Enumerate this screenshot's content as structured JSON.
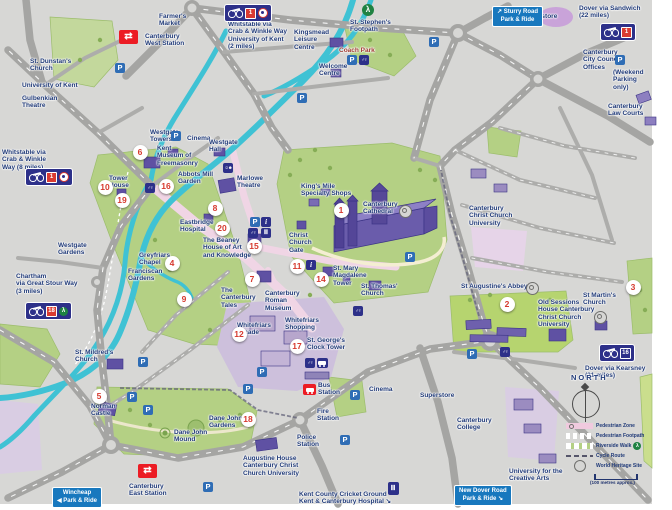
{
  "map_title": "Canterbury city centre visitor map",
  "colors": {
    "background": "#d7d7d5",
    "road": "#a5a5a3",
    "river": "#3fc2d4",
    "park": "#b4d084",
    "pedestrian_zone": "#f0cade",
    "shopping_zone": "#cdc0dc",
    "building": "#5f51a3",
    "label_text": "#203a78",
    "marker_number": "#d6392e",
    "parking_blue": "#2f6db5",
    "sign_navy": "#2d3089",
    "park_ride_blue": "#1878be",
    "rail_red": "#ec1c24",
    "riverside_green": "#1f8242"
  },
  "labels": [
    {
      "t": "University of Kent",
      "x": 22,
      "y": 82
    },
    {
      "t": "Gulbenkian\nTheatre",
      "x": 22,
      "y": 95
    },
    {
      "t": "St. Dunstan's\nChurch",
      "x": 30,
      "y": 58
    },
    {
      "t": "Farmer's\nMarket",
      "x": 159,
      "y": 13
    },
    {
      "t": "Canterbury\nWest Station",
      "x": 145,
      "y": 33
    },
    {
      "t": "Whitstable via\nCrab & Winkle Way\nUniversity of Kent\n(2 miles)",
      "x": 228,
      "y": 21
    },
    {
      "t": "Kingsmead\nLeisure\nCentre",
      "x": 294,
      "y": 29
    },
    {
      "t": "St. Stephen's\nFootpath",
      "x": 350,
      "y": 19
    },
    {
      "t": "Superstore",
      "x": 523,
      "y": 13
    },
    {
      "t": "Coach Park",
      "x": 339,
      "y": 47,
      "c": "#a03a30"
    },
    {
      "t": "Welcome\nCentre",
      "x": 319,
      "y": 63
    },
    {
      "t": "Dover via Sandwich\n(22 miles)",
      "x": 579,
      "y": 5
    },
    {
      "t": "Canterbury\nCity Council\nOffices",
      "x": 583,
      "y": 49
    },
    {
      "t": "(Weekend\nParking\nonly)",
      "x": 613,
      "y": 69
    },
    {
      "t": "Canterbury\nLaw Courts",
      "x": 608,
      "y": 103
    },
    {
      "t": "Whitstable via\nCrab & Winkle\nWay (8 miles)",
      "x": 2,
      "y": 149
    },
    {
      "t": "Westgate\nTowers",
      "x": 150,
      "y": 129
    },
    {
      "t": "Kent\nMuseum of\nFreemasonry",
      "x": 157,
      "y": 145
    },
    {
      "t": "Cinema",
      "x": 187,
      "y": 135
    },
    {
      "t": "Westgate\nHall",
      "x": 209,
      "y": 139
    },
    {
      "t": "Abbots Mill\nGarden",
      "x": 178,
      "y": 171
    },
    {
      "t": "Marlowe\nTheatre",
      "x": 237,
      "y": 175
    },
    {
      "t": "Tower\nHouse",
      "x": 109,
      "y": 175
    },
    {
      "t": "Westgate\nGardens",
      "x": 58,
      "y": 242
    },
    {
      "t": "Eastbridge\nHospital",
      "x": 180,
      "y": 219
    },
    {
      "t": "King's Mile\nSpecialty Shops",
      "x": 301,
      "y": 183
    },
    {
      "t": "Canterbury\nCathedral",
      "x": 363,
      "y": 201
    },
    {
      "t": "Christ\nChurch\nGate",
      "x": 289,
      "y": 232
    },
    {
      "t": "The Beaney\nHouse of Art\nand Knowledge",
      "x": 203,
      "y": 237
    },
    {
      "t": "The\nCanterbury\nTales",
      "x": 221,
      "y": 287
    },
    {
      "t": "Canterbury\nRoman\nMuseum",
      "x": 265,
      "y": 290
    },
    {
      "t": "St. Mary\nMagdalene\nTower",
      "x": 333,
      "y": 265
    },
    {
      "t": "St. Thomas'\nChurch",
      "x": 361,
      "y": 283
    },
    {
      "t": "Greyfriars\nChapel",
      "x": 139,
      "y": 252
    },
    {
      "t": "Franciscan\nGardens",
      "x": 128,
      "y": 268
    },
    {
      "t": "Chartham\nvia Great Stour Way\n(3 miles)",
      "x": 16,
      "y": 273
    },
    {
      "t": "St. Mildred's\nChurch",
      "x": 75,
      "y": 349
    },
    {
      "t": "Norman\nCastle",
      "x": 91,
      "y": 403
    },
    {
      "t": "Whitefriars\nArcade",
      "x": 237,
      "y": 322
    },
    {
      "t": "Whitefriars\nShopping",
      "x": 285,
      "y": 317
    },
    {
      "t": "St. George's\nClock Tower",
      "x": 307,
      "y": 337
    },
    {
      "t": "Bus\nStation",
      "x": 318,
      "y": 382
    },
    {
      "t": "Fire\nStation",
      "x": 317,
      "y": 408
    },
    {
      "t": "Police\nStation",
      "x": 297,
      "y": 434
    },
    {
      "t": "Cinema",
      "x": 369,
      "y": 386
    },
    {
      "t": "Superstore",
      "x": 420,
      "y": 392
    },
    {
      "t": "Dane John\nMound",
      "x": 174,
      "y": 429
    },
    {
      "t": "Dane John\nGardens",
      "x": 209,
      "y": 415
    },
    {
      "t": "Canterbury\nEast Station",
      "x": 129,
      "y": 483
    },
    {
      "t": "Augustine House\nCanterbury Christ\nChurch University",
      "x": 243,
      "y": 455
    },
    {
      "t": "Kent County Cricket Ground\nKent & Canterbury Hospital ↘",
      "x": 299,
      "y": 491
    },
    {
      "t": "Canterbury\nChrist Church\nUniversity",
      "x": 469,
      "y": 205
    },
    {
      "t": "St Augustine's Abbey",
      "x": 461,
      "y": 283
    },
    {
      "t": "Old Sessions\nHouse Canterbury\nChrist Church\nUniversity",
      "x": 538,
      "y": 299
    },
    {
      "t": "St Martin's\nChurch",
      "x": 583,
      "y": 292
    },
    {
      "t": "Canterbury\nCollege",
      "x": 457,
      "y": 417
    },
    {
      "t": "University for the\nCreative Arts",
      "x": 509,
      "y": 468
    },
    {
      "t": "Dover via Kearsney\n(21 miles)",
      "x": 585,
      "y": 365
    },
    {
      "t": "NORTH",
      "x": 571,
      "y": 374,
      "s": 7.5,
      "ls": 2
    }
  ],
  "markers": [
    {
      "n": 1,
      "x": 341,
      "y": 210
    },
    {
      "n": 2,
      "x": 507,
      "y": 304
    },
    {
      "n": 3,
      "x": 633,
      "y": 287
    },
    {
      "n": 4,
      "x": 172,
      "y": 263
    },
    {
      "n": 5,
      "x": 99,
      "y": 396
    },
    {
      "n": 6,
      "x": 140,
      "y": 152
    },
    {
      "n": 7,
      "x": 252,
      "y": 279
    },
    {
      "n": 8,
      "x": 215,
      "y": 208
    },
    {
      "n": 9,
      "x": 184,
      "y": 299
    },
    {
      "n": 10,
      "x": 105,
      "y": 187
    },
    {
      "n": 11,
      "x": 297,
      "y": 266
    },
    {
      "n": 12,
      "x": 239,
      "y": 334
    },
    {
      "n": 14,
      "x": 321,
      "y": 279
    },
    {
      "n": 15,
      "x": 254,
      "y": 246
    },
    {
      "n": 16,
      "x": 166,
      "y": 186
    },
    {
      "n": 17,
      "x": 297,
      "y": 346
    },
    {
      "n": 18,
      "x": 248,
      "y": 419
    },
    {
      "n": 19,
      "x": 122,
      "y": 200
    },
    {
      "n": 20,
      "x": 222,
      "y": 228
    }
  ],
  "icons": {
    "parking": [
      [
        120,
        68
      ],
      [
        176,
        136
      ],
      [
        302,
        98
      ],
      [
        352,
        60
      ],
      [
        434,
        42
      ],
      [
        620,
        60
      ],
      [
        410,
        257
      ],
      [
        255,
        222
      ],
      [
        262,
        372
      ],
      [
        248,
        389
      ],
      [
        355,
        395
      ],
      [
        345,
        440
      ],
      [
        143,
        362
      ],
      [
        132,
        397
      ],
      [
        148,
        410
      ],
      [
        208,
        487
      ],
      [
        472,
        354
      ]
    ],
    "toilets": [
      [
        364,
        60
      ],
      [
        150,
        188
      ],
      [
        253,
        233
      ],
      [
        358,
        311
      ],
      [
        310,
        363
      ],
      [
        505,
        352
      ]
    ],
    "information": [
      [
        266,
        222
      ],
      [
        311,
        265
      ]
    ],
    "museum": [
      [
        266,
        233
      ]
    ],
    "theatre": [
      [
        228,
        168
      ]
    ],
    "bus_point": [
      [
        322,
        363
      ]
    ],
    "world_heritage": [
      [
        404,
        210
      ],
      [
        531,
        287
      ],
      [
        599,
        316
      ]
    ],
    "riverside_walk": [
      [
        368,
        10
      ]
    ],
    "cricket_hospital": [
      [
        393,
        488
      ]
    ]
  },
  "stations": {
    "rail": [
      [
        119,
        30
      ],
      [
        138,
        464
      ]
    ],
    "bus": [
      [
        303,
        384
      ]
    ]
  },
  "cycle_signs": [
    {
      "x": 224,
      "y": 4,
      "plates": [
        "1"
      ],
      "roundel": true
    },
    {
      "x": 25,
      "y": 168,
      "plates": [
        "1"
      ],
      "roundel": true
    },
    {
      "x": 25,
      "y": 302,
      "plates": [
        "18"
      ],
      "walk": true
    },
    {
      "x": 600,
      "y": 23,
      "plates": [
        "1"
      ]
    },
    {
      "x": 599,
      "y": 344,
      "plates": [
        "16"
      ],
      "navyPlate": true
    }
  ],
  "park_and_ride": [
    {
      "text": "↗ Sturry Road\nPark & Ride",
      "x": 492,
      "y": 6
    },
    {
      "text": "Wincheap\n◀ Park & Ride",
      "x": 52,
      "y": 487
    },
    {
      "text": "New Dover Road\nPark & Ride ↘",
      "x": 454,
      "y": 485
    }
  ],
  "compass": {
    "label": "NORTH",
    "x": 572,
    "y": 390
  },
  "legend": {
    "x": 566,
    "y": 421,
    "items": [
      {
        "label": "Pedestrian Zone"
      },
      {
        "label": "Pedestrian Footpath"
      },
      {
        "label": "Riverside Walk",
        "icon": true
      },
      {
        "label": "Cycle Route"
      },
      {
        "label": "World Heritage Site"
      }
    ],
    "scale_text": "(100 metres approx.)"
  }
}
